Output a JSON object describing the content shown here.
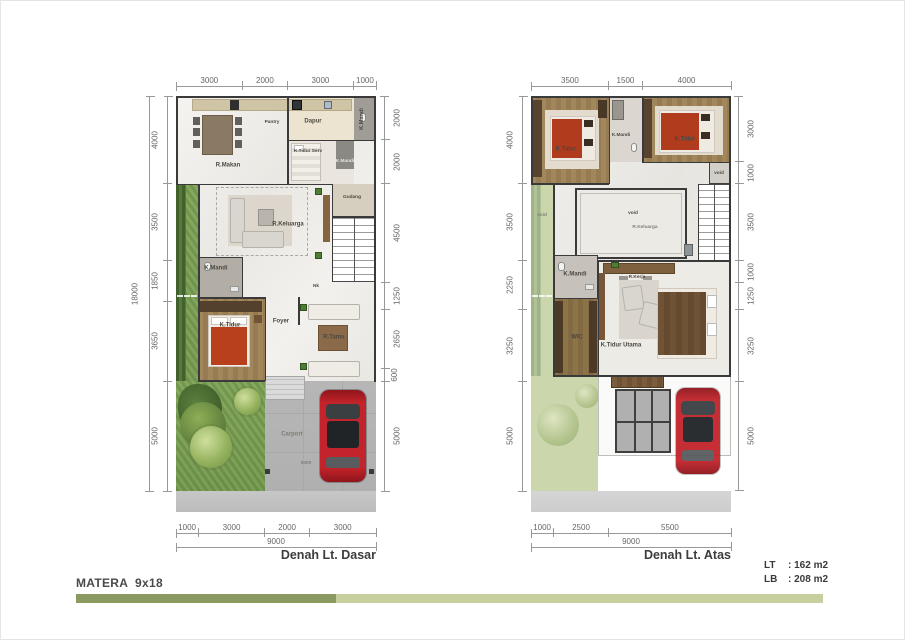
{
  "plans": [
    {
      "caption": "Denah Lt. Dasar",
      "dims": {
        "top": [
          "3000",
          "2000",
          "3000",
          "1000"
        ],
        "left": [
          "4000",
          "3500",
          "1850",
          "3650",
          "5000"
        ],
        "left_total": "18000",
        "right": [
          "2000",
          "2000",
          "4500",
          "1250",
          "2650",
          "600",
          "5000"
        ],
        "bottom": [
          "1000",
          "3000",
          "2000",
          "3000"
        ],
        "bottom_total": "9000"
      },
      "rooms": {
        "r_makan": "R.Makan",
        "pantry": "Pantry",
        "dapur": "Dapur",
        "k_mandi_1": "K.Mandi",
        "k_tidur_serv": "K.Tidur Serv",
        "k_mandi_2": "K.Mandi",
        "gudang": "Gudang",
        "r_keluarga": "R.Keluarga",
        "k_mandi_3": "K.Mandi",
        "naik": "Nk",
        "k_tidur": "K.Tidur",
        "foyer": "Foyer",
        "r_tamu": "R.Tamu",
        "carport": "Carport",
        "carport_width": "5000"
      }
    },
    {
      "caption": "Denah Lt. Atas",
      "dims": {
        "top": [
          "3500",
          "1500",
          "4000"
        ],
        "left": [
          "4000",
          "3500",
          "2250",
          "3250",
          "5000"
        ],
        "right": [
          "3000",
          "1000",
          "3500",
          "1000",
          "1250",
          "3250",
          "5000"
        ],
        "bottom": [
          "1000",
          "2500",
          "5500"
        ],
        "bottom_total": "9000"
      },
      "rooms": {
        "k_tidur_1": "K.Tidur",
        "k_mandi_1": "K.Mandi",
        "k_tidur_2": "K.Tidur",
        "void_shaft": "void",
        "void_taman": "void",
        "void_tengah": "void",
        "r_keluarga": "R.Keluarga",
        "k_mandi_2": "K.Mandi",
        "r_kerja": "R.Kerja",
        "wic": "WIC",
        "k_tidur_utama": "K.Tidur Utama"
      }
    }
  ],
  "footer": {
    "project": "MATERA  9x18",
    "lt_label": "LT",
    "lt_value": ": 162 m2",
    "lb_label": "LB",
    "lb_value": ": 208 m2"
  }
}
